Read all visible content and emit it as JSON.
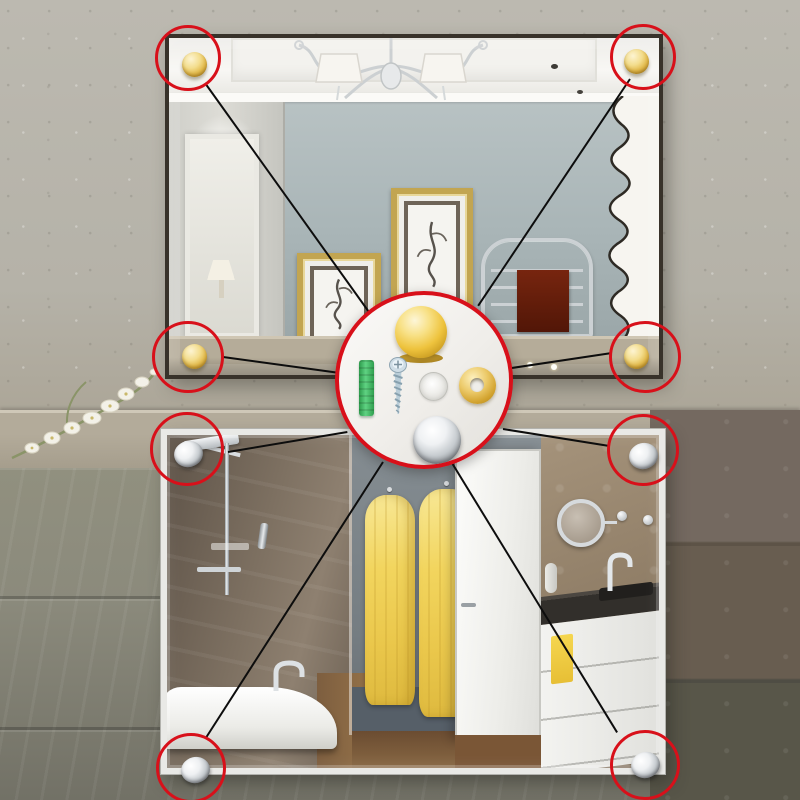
{
  "image": {
    "kind": "product-photo",
    "subject": "Wall mirror fixing kit shown installed on two mirrors with annotated corner caps",
    "aria": {
      "stage": "Product photo: two wall mirrors fixed with decorative corner caps; a red circular callout shows the mounting hardware",
      "top_mirror": "Dark-framed mirror reflecting a living room with chandelier, gold picture frames, towel radiator and white curtain; gold caps at all four corners",
      "bottom_mirror": "White-framed mirror reflecting a bathroom with shower, bathtub, three yellow robes, white door and vanity; chrome caps at all four corners",
      "callout": "Close-up circle of the fixing hardware: gold dome cap, green wall plug, screw, clear gasket, brass ring washer and chrome dome cap",
      "orchid": "White orchid spray on the stone ledge between the mirrors"
    }
  },
  "colors": {
    "annotation_red": "#d8101a",
    "connector_black": "#0d0d0d",
    "gold_cap": "#eec33d",
    "chrome_cap": "#c6cbcf",
    "anchor_green": "#3fae5e",
    "wall_concrete": "#b7b4ab",
    "wall_slate": "#8b8a7c",
    "wall_dark_tile": "#6f6457",
    "top_mirror_frame": "#38322a",
    "bottom_mirror_frame": "#e9e9e6",
    "robe_yellow": "#f2d55e",
    "towel_red": "#6b2010"
  },
  "callout_items": [
    {
      "name": "gold-dome-cap",
      "finish": "polished gold"
    },
    {
      "name": "green-wall-plug",
      "finish": "green plastic expansion anchor"
    },
    {
      "name": "mounting-screw",
      "finish": "zinc-plated steel"
    },
    {
      "name": "clear-gasket",
      "finish": "translucent plastic"
    },
    {
      "name": "brass-ring-washer",
      "finish": "brass"
    },
    {
      "name": "chrome-dome-cap",
      "finish": "polished chrome"
    }
  ],
  "markers": {
    "center": {
      "id": "hardware-callout"
    },
    "corners": [
      {
        "id": "top-mirror-top-left",
        "cap": "gold"
      },
      {
        "id": "top-mirror-top-right",
        "cap": "gold"
      },
      {
        "id": "top-mirror-bottom-left",
        "cap": "gold"
      },
      {
        "id": "top-mirror-bottom-right",
        "cap": "gold"
      },
      {
        "id": "bottom-mirror-top-left",
        "cap": "chrome"
      },
      {
        "id": "bottom-mirror-top-right",
        "cap": "chrome"
      },
      {
        "id": "bottom-mirror-bottom-left",
        "cap": "chrome"
      },
      {
        "id": "bottom-mirror-bottom-right",
        "cap": "chrome"
      }
    ]
  }
}
